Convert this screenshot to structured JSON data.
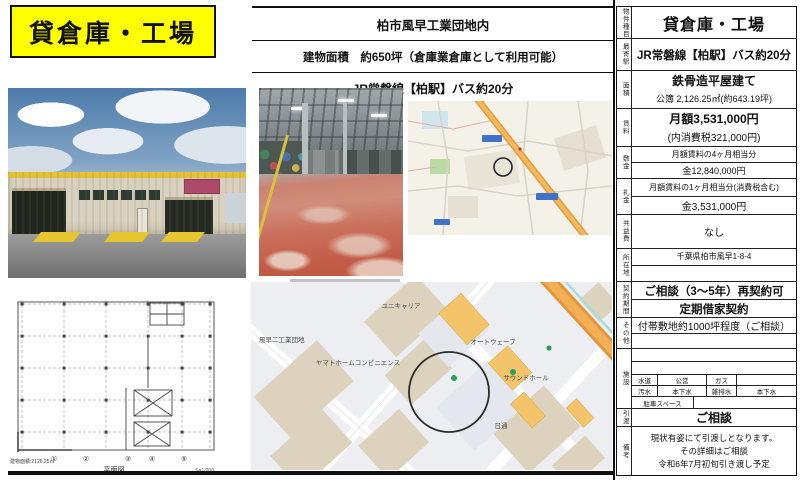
{
  "title_box": {
    "text": "貸倉庫・工場"
  },
  "header": {
    "line1": "柏市風早工業団地内",
    "line2": "建物面積　約650坪（倉庫業倉庫として利用可能）",
    "line3": "JR常磐線【柏駅】バス約20分"
  },
  "table": {
    "rows": [
      {
        "label": "物件種目",
        "lines": [
          "貸倉庫・工場"
        ]
      },
      {
        "label": "最寄駅",
        "lines": [
          "JR常磐線【柏駅】バス約20分"
        ]
      },
      {
        "label": "面積",
        "lines": [
          "鉄骨造平屋建て",
          "公簿 2,126.25㎡(約643.19坪)"
        ]
      },
      {
        "label": "賃料",
        "lines": [
          "月額3,531,000円",
          "(内消費税321,000円)"
        ]
      },
      {
        "label": "敷金",
        "lines": [
          "月額賃料の4ヶ月相当分",
          "金12,840,000円"
        ]
      },
      {
        "label": "礼金",
        "lines": [
          "月額賃料の1ヶ月相当分(消費税含む)",
          "金3,531,000円"
        ]
      },
      {
        "label": "共益費",
        "lines": [
          "なし"
        ]
      },
      {
        "label": "所在地",
        "lines": [
          "千葉県柏市風早1-8-4"
        ]
      },
      {
        "label": "契約期間",
        "lines": [
          "ご相談（3〜5年）再契約可",
          "定期借家契約"
        ]
      },
      {
        "label": "その他",
        "lines": [
          "付帯敷地約1000坪程度（ご相談）"
        ]
      },
      {
        "label": "施設",
        "facility": [
          [
            "水道",
            "公営",
            "ガス",
            ""
          ],
          [
            "汚水",
            "本下水",
            "雑排水",
            "本下水"
          ],
          [
            "駐車スペース",
            ""
          ]
        ]
      },
      {
        "label": "引渡",
        "lines": [
          "ご相談"
        ]
      },
      {
        "label": "備考",
        "lines": [
          "現状有姿にて引渡しとなります。",
          "その詳細はご相談",
          "令和6年7月初旬引き渡し予定"
        ]
      }
    ]
  },
  "floorplan": {
    "caption": "平面図",
    "area_note": "建物面積:2126.25㎡",
    "scale_note": "S=1/200",
    "axes": [
      "①",
      "②",
      "③",
      "④",
      "⑤"
    ]
  },
  "maps": {
    "large": {
      "labels": {
        "unicarrier": "ユニキャリア",
        "danchi": "風早二工業団地",
        "yamato": "ヤマトホームコンビニエンス",
        "autowave": "オートウェーブ",
        "soundhall": "サウンドホール",
        "nittsu": "日通"
      }
    }
  },
  "colors": {
    "title_bg": "#ffff00",
    "map_road_orange": "#f0a43f",
    "map_building_tan": "#ddd2bd",
    "map_building_orange": "#f3c469"
  }
}
